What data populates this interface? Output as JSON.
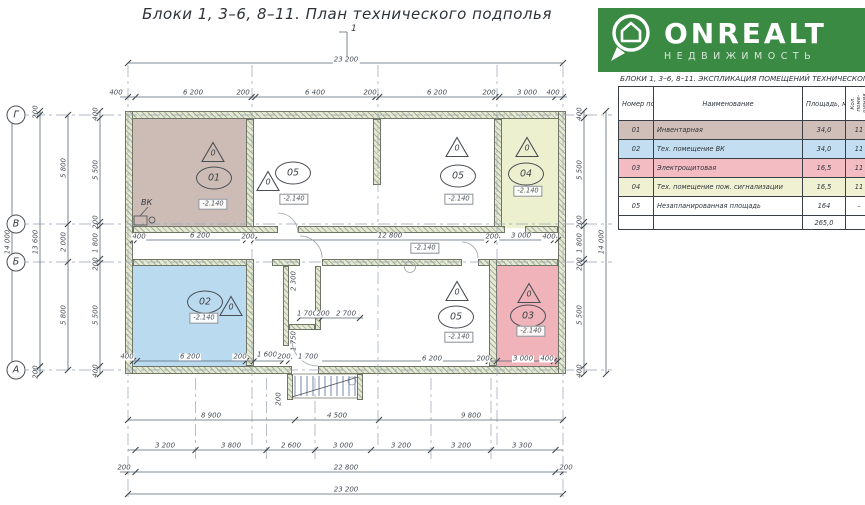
{
  "title": "Блоки 1,  3–6, 8–11.    План технического подполья",
  "section_mark": "1",
  "logo": {
    "brand": "ONREALT",
    "subtitle": "НЕДВИЖИМОСТЬ",
    "bg": "#3a8a44"
  },
  "legend": {
    "title": "БЛОКИ 1,  3–6, 8–11.  ЭКСПЛИКАЦИЯ ПОМЕЩЕНИЙ ТЕХНИЧЕСКОГО ЭТАЖА",
    "col_num": "Номер\nпоме-\nщения",
    "col_name": "Наименование",
    "col_area": "Площадь,\nм²",
    "col_count": "Кол. поме-\nщения",
    "rows": [
      {
        "num": "01",
        "name": "Инвентарная",
        "area": "34,0",
        "count": "11",
        "color": "#d0bfb8"
      },
      {
        "num": "02",
        "name": "Тех. помещение ВК",
        "area": "34,0",
        "count": "11",
        "color": "#c3ddf1"
      },
      {
        "num": "03",
        "name": "Электрощитовая",
        "area": "16,5",
        "count": "11",
        "color": "#f3bcc2"
      },
      {
        "num": "04",
        "name": "Тех. помещение пож. сигнализации",
        "area": "16,5",
        "count": "11",
        "color": "#eff1d2"
      },
      {
        "num": "05",
        "name": "Незапланированная площадь",
        "area": "164",
        "count": "–",
        "color": "#ffffff"
      }
    ],
    "total": "265,0"
  },
  "plan": {
    "axes": {
      "g": "Г",
      "v": "В",
      "b": "Б",
      "a": "А"
    },
    "vk": "ВК",
    "tri": "0",
    "elev": "-2.140",
    "rooms": {
      "r01": "01",
      "r02": "02",
      "r03": "03",
      "r04": "04",
      "r05": "05"
    },
    "room_colors": {
      "r01": "#cdbcb5",
      "r02": "#badaf0",
      "r03": "#f0b3ba",
      "r04": "#edf0cf"
    },
    "dims": {
      "top_total": "23 200",
      "t1": "400",
      "t2": "6 200",
      "t3": "200",
      "t4": "6 400",
      "t5": "200",
      "t6": "6 200",
      "t7": "200",
      "t8": "3 000",
      "t9": "400",
      "left_total": "14 000",
      "l1": "200",
      "l2": "13 600",
      "l3": "200",
      "la1": "5 800",
      "la2": "2 000",
      "la3": "5 800",
      "li1": "400",
      "li2": "5 500",
      "li3": "200",
      "li4": "1 800",
      "li5": "200",
      "li6": "5 500",
      "li7": "400",
      "right_total": "14 000",
      "ri1": "400",
      "ri2": "5 500",
      "ri3": "200",
      "ri4": "1 800",
      "ri5": "200",
      "ri6": "5 500",
      "ri7": "400",
      "b1": "8 900",
      "b2": "4 500",
      "b3": "9 800",
      "c1": "3 200",
      "c2": "3 800",
      "c3": "2 600",
      "c4": "3 000",
      "c5": "3 200",
      "c6": "3 200",
      "c7": "3 300",
      "e_l": "200",
      "inner_total": "22 800",
      "e_r": "200",
      "bottom_total": "23 200",
      "m1": "400",
      "m2": "6 200",
      "m3": "200",
      "m4": "12 800",
      "m5": "200",
      "m6": "3 000",
      "m7": "400",
      "f1": "400",
      "f2": "6 200",
      "f3": "200",
      "f4": "1 600",
      "f5": "200",
      "f6": "1 700",
      "f7": "6 200",
      "f8": "200",
      "f9": "3 000",
      "f10": "400",
      "s1": "1 700",
      "s2": "200",
      "s3": "2 700",
      "s4": "2 300",
      "s5": "1 750",
      "s6": "200"
    }
  }
}
